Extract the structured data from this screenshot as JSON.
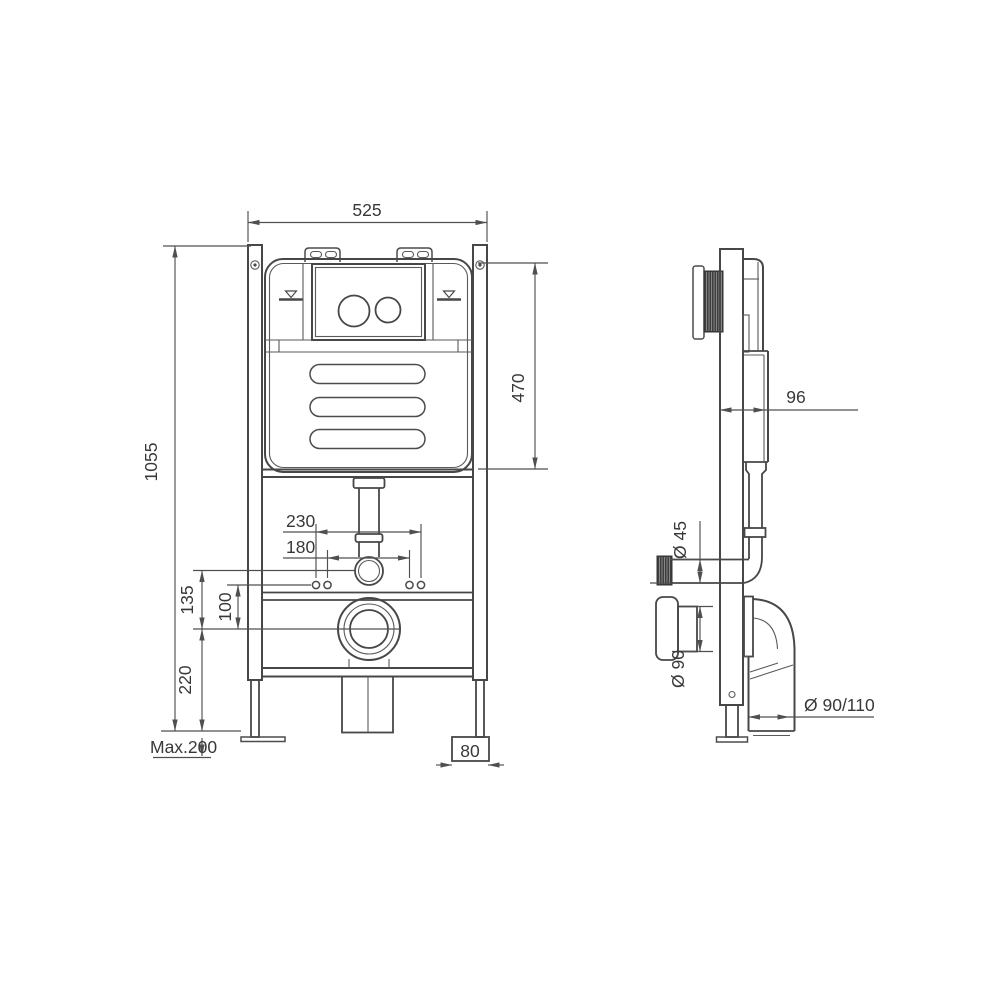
{
  "page": {
    "background": "#ffffff",
    "line_color": "#474747",
    "text_color": "#383838"
  },
  "drawing": {
    "type": "technical-drawing",
    "subject": "Concealed cistern wall-mounting frame for wall-hung toilet — front and side elevations with installation dimensions (mm)",
    "front_view": {
      "name": "front-elevation",
      "dimensions": {
        "frame_width": "525",
        "frame_height": "1055",
        "cistern_height": "470",
        "fixing_spread_outer": "230",
        "fixing_spread_inner": "180",
        "flush_bend_to_outlet": "135",
        "fixing_to_outlet": "100",
        "outlet_center_height": "220",
        "leg_adjustment": "Max.200",
        "foot_width": "80"
      }
    },
    "side_view": {
      "name": "side-elevation",
      "dimensions": {
        "frame_depth": "96",
        "flush_pipe_diameter": "Ø 45",
        "outlet_flange_diameter": "Ø 90",
        "outlet_pipe_diameter": "Ø 90/110"
      }
    }
  }
}
